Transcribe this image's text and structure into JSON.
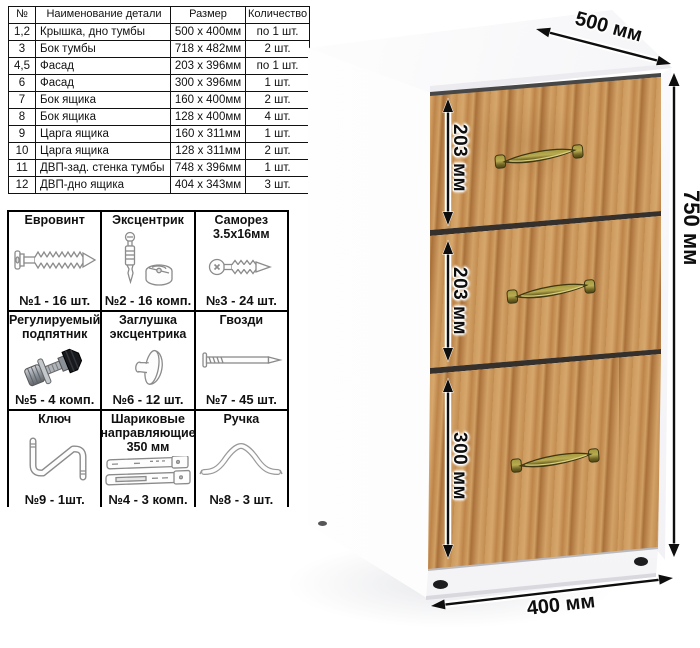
{
  "parts_table": {
    "headers": [
      "№",
      "Наименование детали",
      "Размер",
      "Количество"
    ],
    "rows": [
      [
        "1,2",
        "Крышка, дно тумбы",
        "500 x 400мм",
        "по 1 шт."
      ],
      [
        "3",
        "Бок тумбы",
        "718 x 482мм",
        "2 шт."
      ],
      [
        "4,5",
        "Фасад",
        "203 x 396мм",
        "по 1 шт."
      ],
      [
        "6",
        "Фасад",
        "300 x 396мм",
        "1 шт."
      ],
      [
        "7",
        "Бок ящика",
        "160 x 400мм",
        "2 шт."
      ],
      [
        "8",
        "Бок ящика",
        "128 x 400мм",
        "4 шт."
      ],
      [
        "9",
        "Царга ящика",
        "160 x 311мм",
        "1 шт."
      ],
      [
        "10",
        "Царга ящика",
        "128 x 311мм",
        "2 шт."
      ],
      [
        "11",
        "ДВП-зад. стенка тумбы",
        "748 x 396мм",
        "1 шт."
      ],
      [
        "12",
        "ДВП-дно ящика",
        "404 x 343мм",
        "3 шт."
      ]
    ]
  },
  "hardware": {
    "cells": [
      {
        "title": "Евровинт",
        "qty": "№1 - 16 шт.",
        "icon": "confirmat-screw-icon"
      },
      {
        "title": "Эксцентрик",
        "qty": "№2 - 16 комп.",
        "icon": "eccentric-cam-icon"
      },
      {
        "title": "Саморез 3.5х16мм",
        "qty": "№3 - 24 шт.",
        "icon": "self-tapping-screw-icon"
      },
      {
        "title": "Регулируемый подпятник",
        "qty": "№5 - 4 комп.",
        "icon": "adjustable-foot-icon"
      },
      {
        "title": "Заглушка эксцентрика",
        "qty": "№6 - 12 шт.",
        "icon": "eccentric-cap-icon"
      },
      {
        "title": "Гвозди",
        "qty": "№7 - 45 шт.",
        "icon": "nail-icon"
      },
      {
        "title": "Ключ",
        "qty": "№9 - 1шт.",
        "icon": "hex-key-icon"
      },
      {
        "title": "Шариковые направляющие 350 мм",
        "qty": "№4 - 3 комп.",
        "icon": "ball-bearing-slides-icon"
      },
      {
        "title": "Ручка",
        "qty": "№8 - 3 шт.",
        "icon": "drawer-handle-icon"
      }
    ]
  },
  "dimensions": {
    "top_width": "500 мм",
    "height": "750 мм",
    "drawer1_height": "203 мм",
    "drawer2_height": "203 мм",
    "drawer3_height": "300 мм",
    "bottom_depth": "400 мм"
  },
  "colors": {
    "wood_base": "#c8945a",
    "handle_brass": "#8a7d33",
    "arrow": "#0e0e0e",
    "cabinet_body": "#ffffff"
  }
}
